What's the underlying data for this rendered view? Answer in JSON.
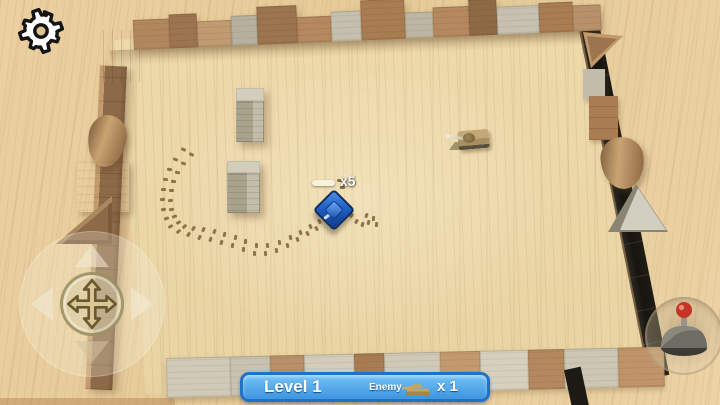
{
  "hud": {
    "level_label": "Level 1",
    "enemy_label": "Enemy",
    "enemy_count": "x 1",
    "banner": {
      "fill_top": "#74c3f6",
      "fill_bottom": "#3d95df",
      "border": "#1f72c8",
      "text_color": "#ffffff"
    }
  },
  "player": {
    "ammo_label": "x5",
    "x": 334,
    "y": 210,
    "color": "#1f5fc4"
  },
  "enemy": {
    "x": 470,
    "y": 139,
    "color": "#b89d6c"
  },
  "icons": {
    "settings": "gear-icon",
    "move_pad": "move-cross-icon",
    "fire_button": "fire-stick-icon",
    "enemy_counter": "tank-icon"
  },
  "colors": {
    "table_wood": "#e8cf9f",
    "arena_floor": "#ecd8ab",
    "wall_dark": "#1c1a15",
    "wall_brown": "#8d6a47",
    "block_gray": "#bfb9a6",
    "track_mark": "#7d6138"
  },
  "top_wall_blocks": [
    {
      "w": 36,
      "h": 30,
      "c": "#b1885e"
    },
    {
      "w": 28,
      "h": 34,
      "c": "#9c7450"
    },
    {
      "w": 34,
      "h": 26,
      "c": "#c09a70"
    },
    {
      "w": 26,
      "h": 30,
      "c": "#b6b09e"
    },
    {
      "w": 40,
      "h": 38,
      "c": "#9c744e"
    },
    {
      "w": 34,
      "h": 26,
      "c": "#b5885f"
    },
    {
      "w": 30,
      "h": 30,
      "c": "#c4bfae"
    },
    {
      "w": 44,
      "h": 40,
      "c": "#a97c52"
    },
    {
      "w": 28,
      "h": 26,
      "c": "#bdb6a2"
    },
    {
      "w": 36,
      "h": 30,
      "c": "#b5885f"
    },
    {
      "w": 28,
      "h": 36,
      "c": "#8f6a46"
    },
    {
      "w": 42,
      "h": 28,
      "c": "#c6c1b0"
    },
    {
      "w": 34,
      "h": 30,
      "c": "#a97c52"
    },
    {
      "w": 28,
      "h": 26,
      "c": "#b8906a"
    }
  ],
  "bottom_wall_blocks": [
    {
      "w": 64,
      "h": 40,
      "c": "#d0cab6"
    },
    {
      "w": 40,
      "h": 40,
      "c": "#c8c2ae"
    },
    {
      "w": 34,
      "h": 40,
      "c": "#b8916a"
    },
    {
      "w": 50,
      "h": 40,
      "c": "#d2ccb8"
    },
    {
      "w": 30,
      "h": 40,
      "c": "#a87c52"
    },
    {
      "w": 56,
      "h": 40,
      "c": "#cfc9b5"
    },
    {
      "w": 40,
      "h": 40,
      "c": "#c29a6e"
    },
    {
      "w": 48,
      "h": 40,
      "c": "#d6d0bc"
    },
    {
      "w": 36,
      "h": 40,
      "c": "#b5885f"
    },
    {
      "w": 54,
      "h": 40,
      "c": "#ccc6b2"
    },
    {
      "w": 46,
      "h": 40,
      "c": "#c09468"
    }
  ],
  "track_marks": [
    [
      181,
      148,
      25
    ],
    [
      189,
      153,
      25
    ],
    [
      173,
      158,
      20
    ],
    [
      181,
      162,
      20
    ],
    [
      167,
      168,
      10
    ],
    [
      175,
      171,
      10
    ],
    [
      163,
      178,
      5
    ],
    [
      171,
      180,
      5
    ],
    [
      161,
      188,
      0
    ],
    [
      169,
      189,
      0
    ],
    [
      160,
      198,
      -5
    ],
    [
      168,
      199,
      -5
    ],
    [
      161,
      208,
      -10
    ],
    [
      169,
      208,
      -10
    ],
    [
      164,
      217,
      -20
    ],
    [
      172,
      215,
      -20
    ],
    [
      168,
      225,
      -30
    ],
    [
      176,
      221,
      -30
    ],
    [
      176,
      230,
      -40
    ],
    [
      182,
      225,
      -40
    ],
    [
      186,
      233,
      -55
    ],
    [
      191,
      227,
      -55
    ],
    [
      197,
      236,
      -65
    ],
    [
      201,
      228,
      -65
    ],
    [
      208,
      238,
      -70
    ],
    [
      212,
      230,
      -70
    ],
    [
      219,
      241,
      -75
    ],
    [
      222,
      233,
      -75
    ],
    [
      230,
      244,
      -80
    ],
    [
      233,
      236,
      -80
    ],
    [
      241,
      248,
      -85
    ],
    [
      243,
      240,
      -85
    ],
    [
      252,
      252,
      -90
    ],
    [
      254,
      244,
      -90
    ],
    [
      263,
      252,
      -95
    ],
    [
      265,
      244,
      -95
    ],
    [
      274,
      249,
      -100
    ],
    [
      277,
      241,
      -100
    ],
    [
      285,
      244,
      -105
    ],
    [
      288,
      236,
      -105
    ],
    [
      295,
      238,
      -110
    ],
    [
      298,
      231,
      -110
    ],
    [
      305,
      232,
      -115
    ],
    [
      308,
      225,
      -115
    ],
    [
      314,
      227,
      -120
    ],
    [
      317,
      220,
      -120
    ],
    [
      349,
      214,
      -60
    ],
    [
      354,
      220,
      -60
    ],
    [
      360,
      223,
      -75
    ],
    [
      366,
      221,
      -75
    ],
    [
      371,
      217,
      -85
    ],
    [
      374,
      223,
      -85
    ],
    [
      364,
      214,
      -70
    ],
    [
      337,
      179,
      0
    ],
    [
      340,
      186,
      0
    ]
  ]
}
